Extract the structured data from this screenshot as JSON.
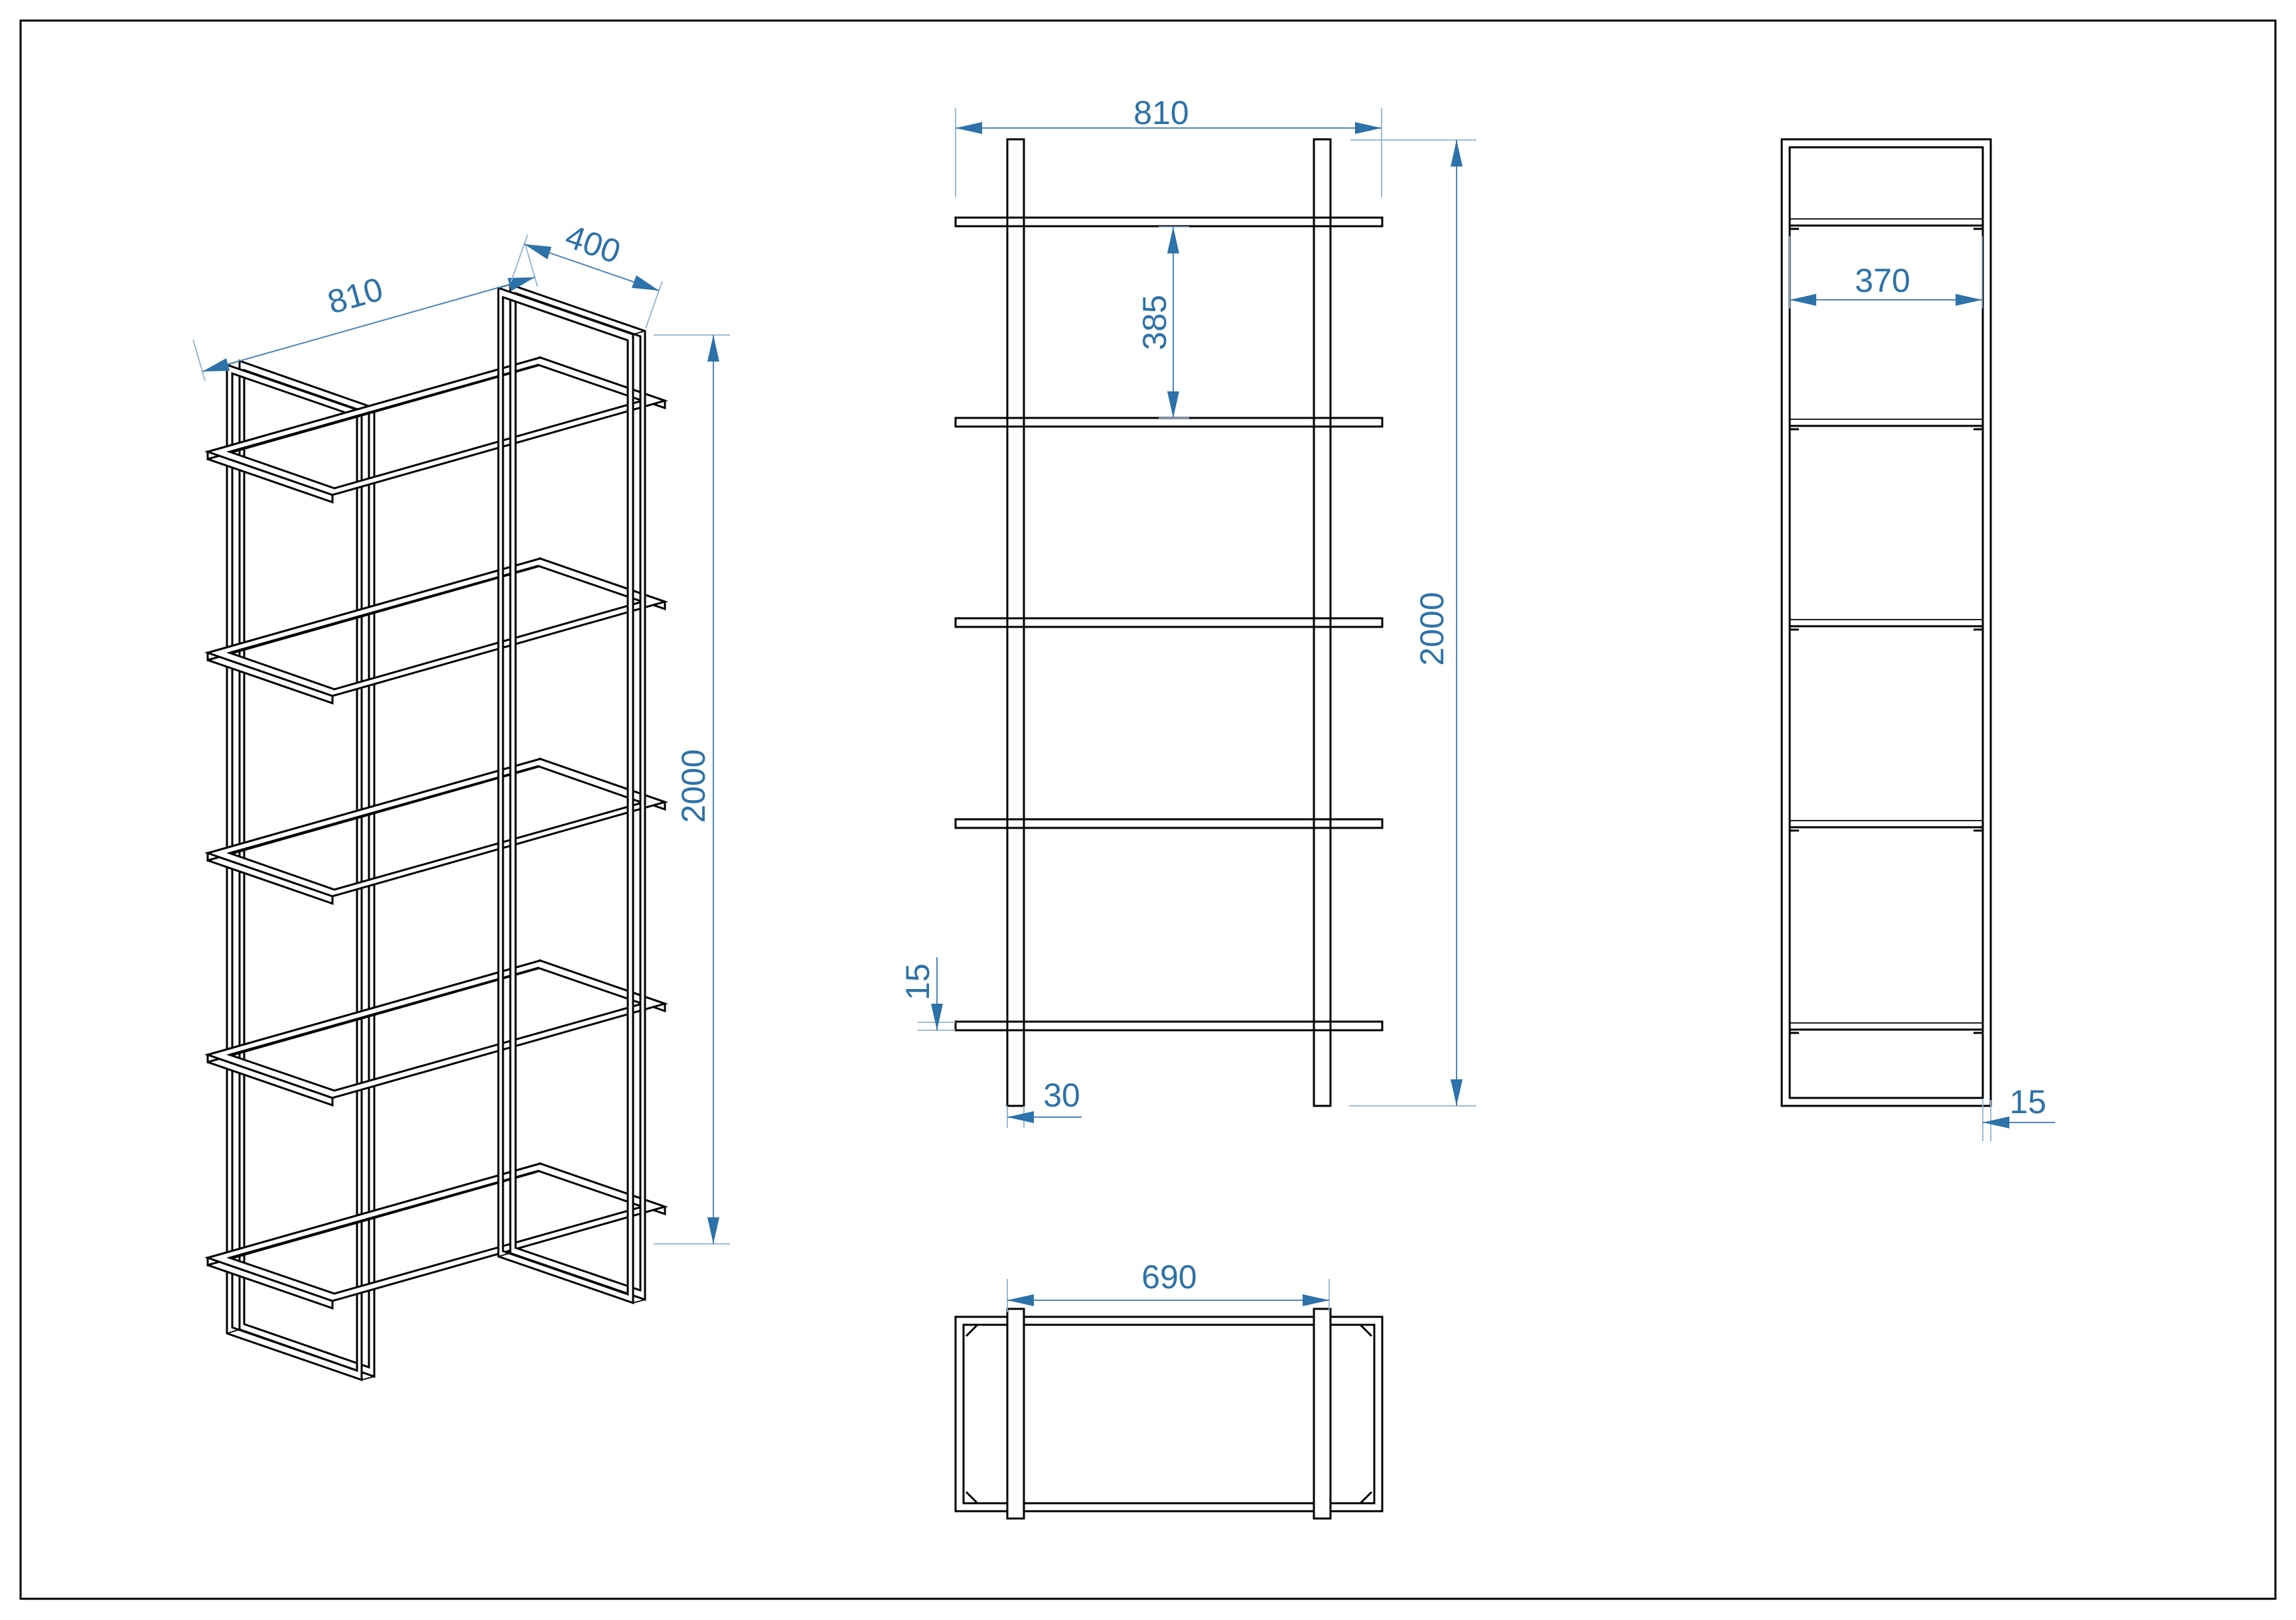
{
  "drawing": {
    "type": "technical-drawing",
    "subject": "metal shelving unit with 5 shelf frames and two side ladder frames",
    "units": "mm",
    "colors": {
      "line": "#000000",
      "dimension": "#2D72A8",
      "background": "#FFFFFF"
    },
    "views": {
      "isometric": {
        "name": "isometric view",
        "dims": {
          "width": "810",
          "depth": "400",
          "height": "2000"
        }
      },
      "front": {
        "name": "front view",
        "dims": {
          "width": "810",
          "shelf_gap": "385",
          "height": "2000",
          "shelf_thickness": "15",
          "post_width": "30"
        }
      },
      "side": {
        "name": "side view",
        "dims": {
          "inner_depth": "370",
          "frame_thickness": "15"
        }
      },
      "top": {
        "name": "top view",
        "dims": {
          "frame_outer_spacing": "690"
        }
      }
    }
  }
}
